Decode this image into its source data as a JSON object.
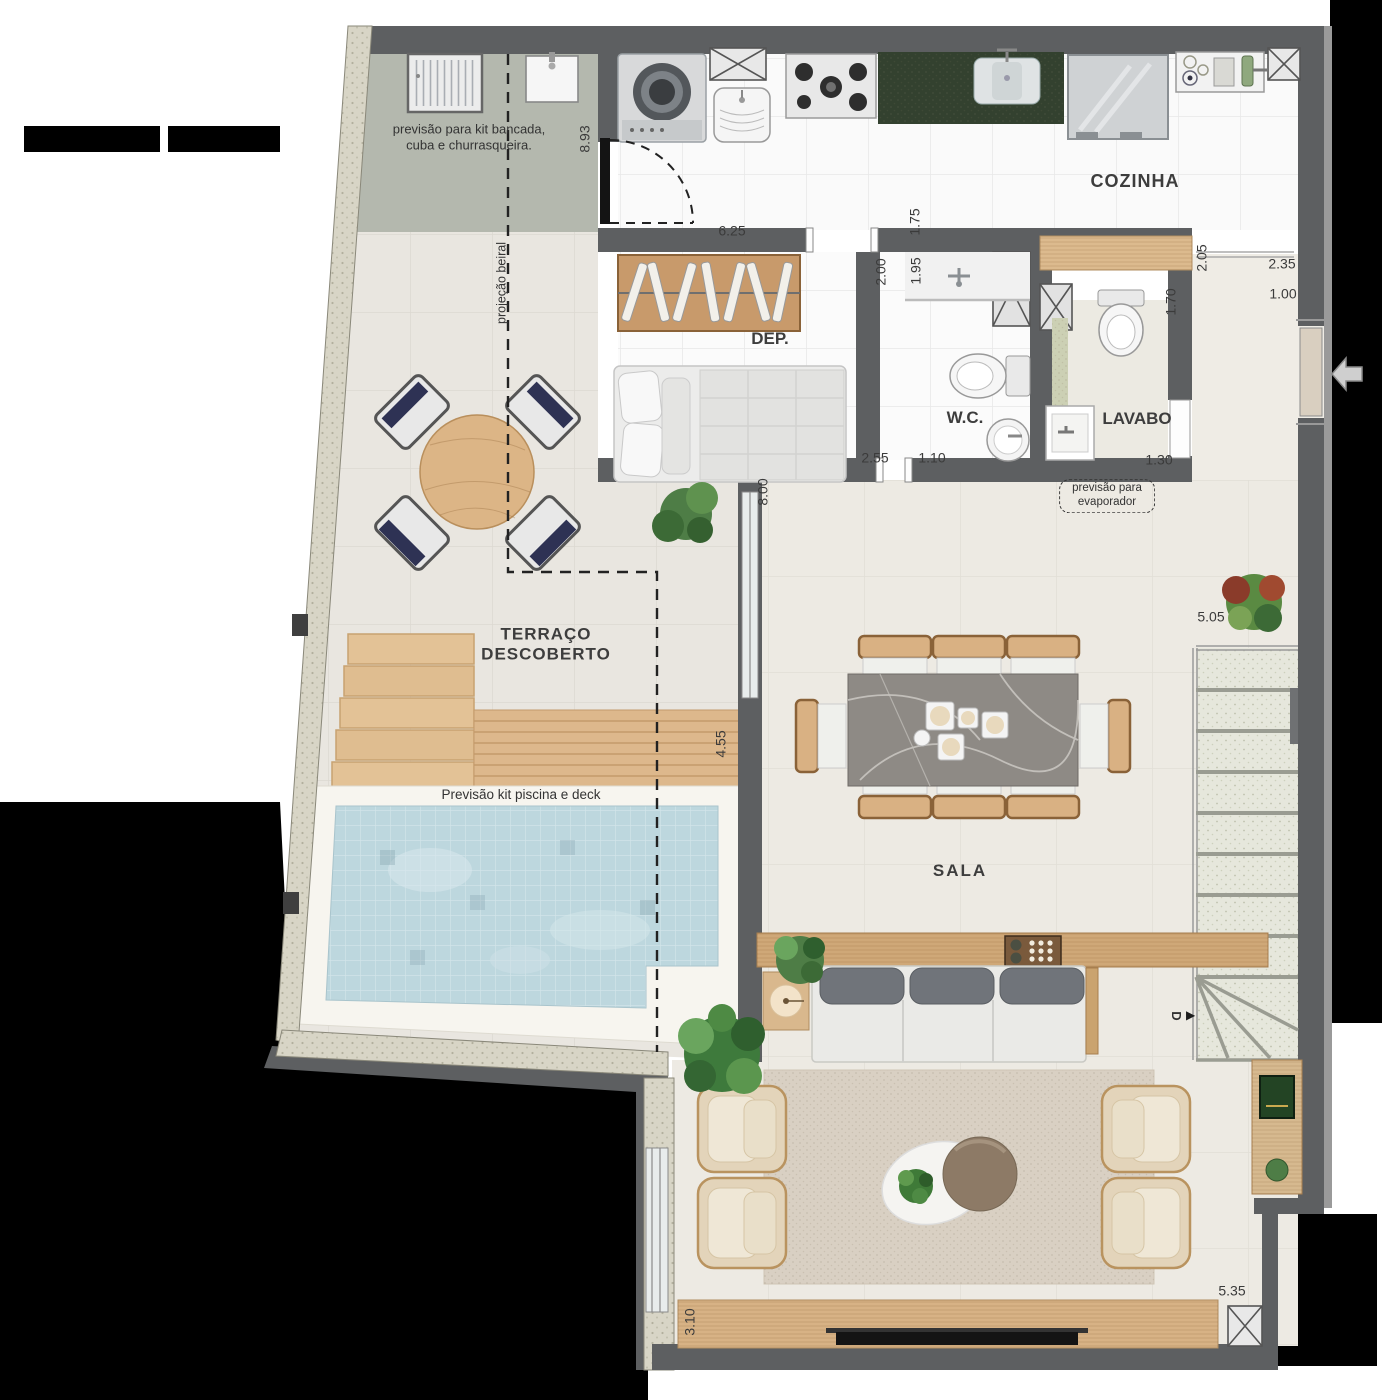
{
  "plan": {
    "type": "floor-plan",
    "icons": {
      "stairs_down_arrow": "▶"
    },
    "colors": {
      "wall": "#5d5f61",
      "pool_water": "#bdd7de",
      "deck_wood": "#ddb88c",
      "furniture_wood": "#cfa878",
      "bbq_concrete": "#b4b8ae",
      "label_text": "#3b3b3b"
    },
    "labels": {
      "rooms": [
        {
          "name": "room-label-cozinha",
          "text": "COZINHA",
          "x": 1135,
          "y": 182,
          "size": 18,
          "ls": 1
        },
        {
          "name": "room-label-dep",
          "text": "DEP.",
          "x": 770,
          "y": 339,
          "size": 17
        },
        {
          "name": "room-label-wc",
          "text": "W.C.",
          "x": 965,
          "y": 418,
          "size": 17
        },
        {
          "name": "room-label-lavabo",
          "text": "LAVABO",
          "x": 1137,
          "y": 419,
          "size": 17
        },
        {
          "name": "room-label-terraco",
          "text": "TERRAÇO\nDESCOBERTO",
          "x": 546,
          "y": 645,
          "size": 17,
          "ls": 1
        },
        {
          "name": "room-label-sala",
          "text": "SALA",
          "x": 960,
          "y": 871,
          "size": 17,
          "ls": 2
        }
      ],
      "notes": [
        {
          "name": "note-kit-bancada",
          "text": "previsão para kit bancada,\ncuba e churrasqueira.",
          "x": 469,
          "y": 137,
          "size": 13
        },
        {
          "name": "note-projecao-beiral",
          "text": "projeção beiral",
          "x": 502,
          "y": 283,
          "size": 12.5,
          "rot": -90
        },
        {
          "name": "note-piscina-deck",
          "text": "Previsão kit piscina e deck",
          "x": 521,
          "y": 795,
          "size": 13.5
        },
        {
          "name": "note-evaporador",
          "text": "previsão para\nevaporador",
          "x": 1107,
          "y": 496,
          "size": 11.5,
          "boxed": true
        },
        {
          "name": "stairs-direction-label",
          "text": "D",
          "x": 1176,
          "y": 1016,
          "size": 13,
          "rot": 90,
          "bold": true
        }
      ],
      "dimensions": [
        {
          "text": "8.93",
          "x": 585,
          "y": 139,
          "rot": -90
        },
        {
          "text": "6.25",
          "x": 732,
          "y": 231
        },
        {
          "text": "1.75",
          "x": 915,
          "y": 222,
          "rot": -90
        },
        {
          "text": "2.00",
          "x": 881,
          "y": 272,
          "rot": -90
        },
        {
          "text": "1.95",
          "x": 916,
          "y": 271,
          "rot": -90
        },
        {
          "text": "2.05",
          "x": 1202,
          "y": 258,
          "rot": -90
        },
        {
          "text": "2.35",
          "x": 1282,
          "y": 264
        },
        {
          "text": "1.00",
          "x": 1283,
          "y": 294
        },
        {
          "text": "1.70",
          "x": 1171,
          "y": 302,
          "rot": -90
        },
        {
          "text": "2.55",
          "x": 875,
          "y": 458
        },
        {
          "text": "1.10",
          "x": 932,
          "y": 458
        },
        {
          "text": "1.30",
          "x": 1159,
          "y": 460
        },
        {
          "text": "8.00",
          "x": 763,
          "y": 492,
          "rot": -90
        },
        {
          "text": "5.05",
          "x": 1211,
          "y": 617
        },
        {
          "text": "4.55",
          "x": 721,
          "y": 744,
          "rot": -90
        },
        {
          "text": "3.10",
          "x": 690,
          "y": 1322,
          "rot": -90
        },
        {
          "text": "5.35",
          "x": 1232,
          "y": 1291
        }
      ]
    }
  }
}
